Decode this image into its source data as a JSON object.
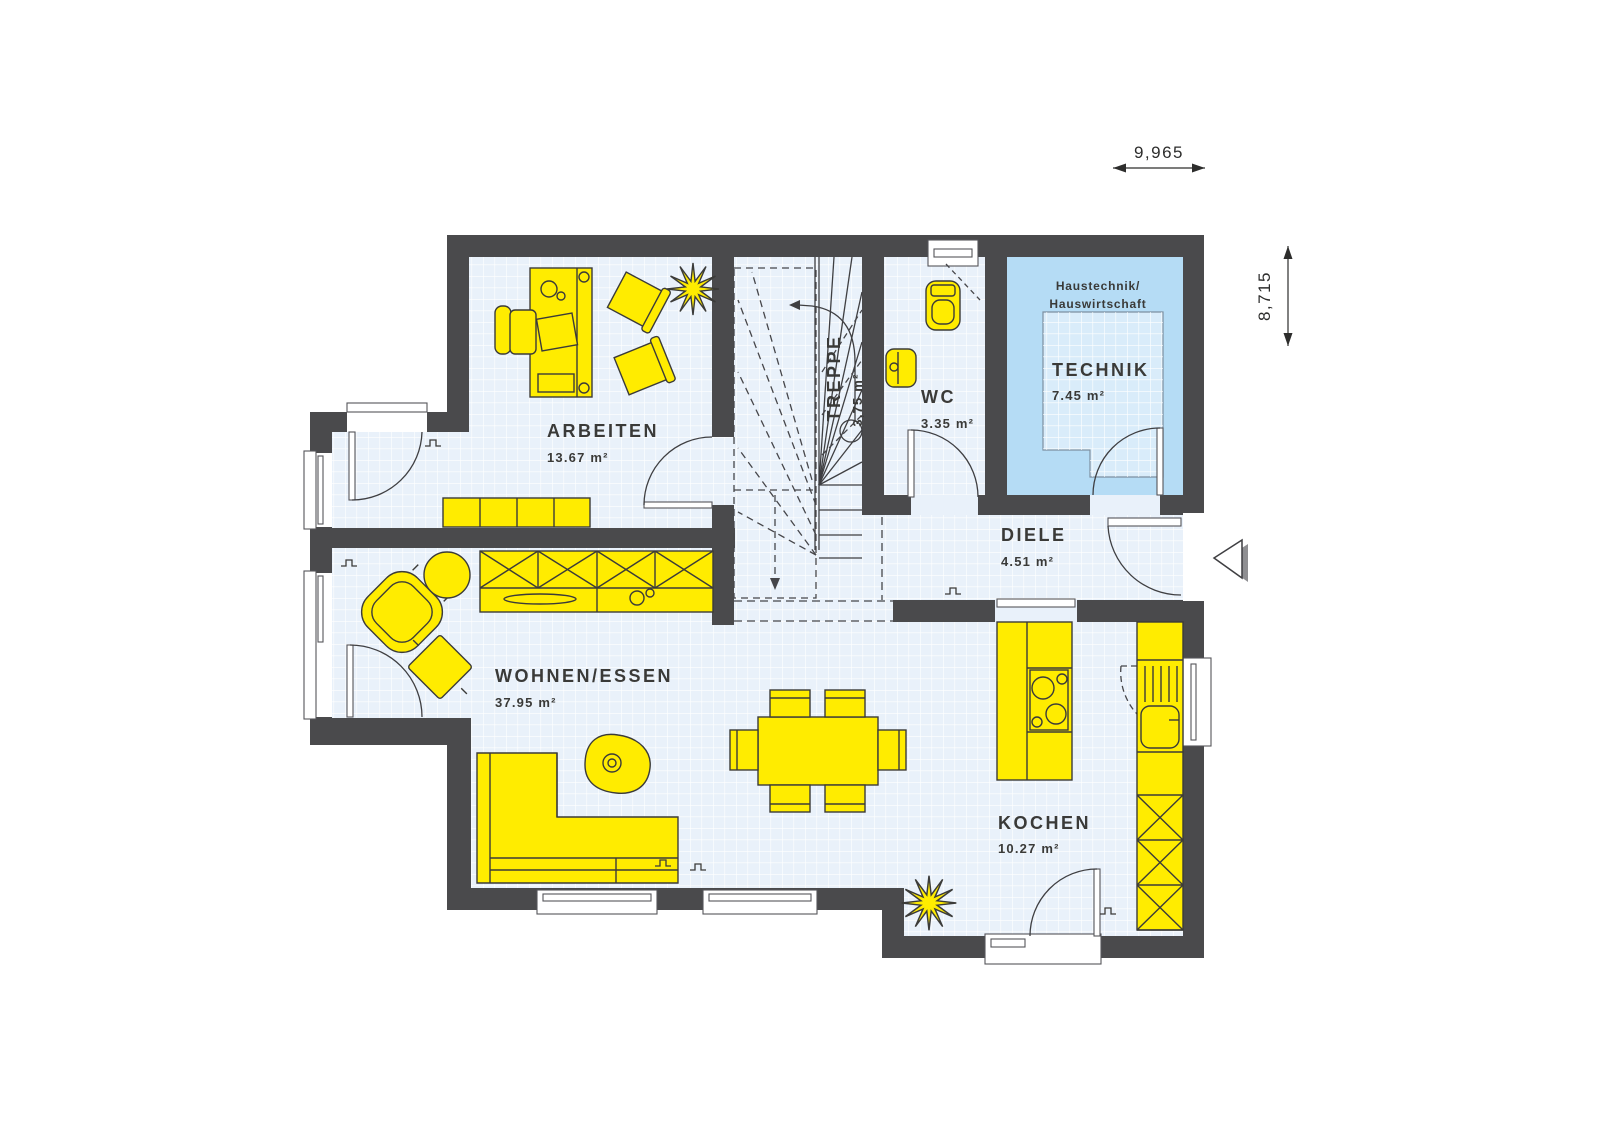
{
  "dimensions": {
    "width": "9,965",
    "height": "8,715"
  },
  "rooms": {
    "arbeiten": {
      "name": "ARBEITEN",
      "area": "13.67 m²"
    },
    "treppe": {
      "name": "TREPPE",
      "area": "3,75 m²"
    },
    "wc": {
      "name": "WC",
      "area": "3.35 m²"
    },
    "technik": {
      "name": "TECHNIK",
      "area": "7.45 m²",
      "note1": "Haustechnik/",
      "note2": "Hauswirtschaft"
    },
    "diele": {
      "name": "DIELE",
      "area": "4.51 m²"
    },
    "wohnen": {
      "name": "WOHNEN/ESSEN",
      "area": "37.95 m²"
    },
    "kochen": {
      "name": "KOCHEN",
      "area": "10.27 m²"
    }
  },
  "colors": {
    "wall": "#4a4a4c",
    "floor": "#e9f1fa",
    "technik_floor": "#b5dcf5",
    "technik_inner": "#d9ecfa",
    "furniture": "#ffec00",
    "outline": "#3b3b39",
    "text": "#3a3a38"
  }
}
